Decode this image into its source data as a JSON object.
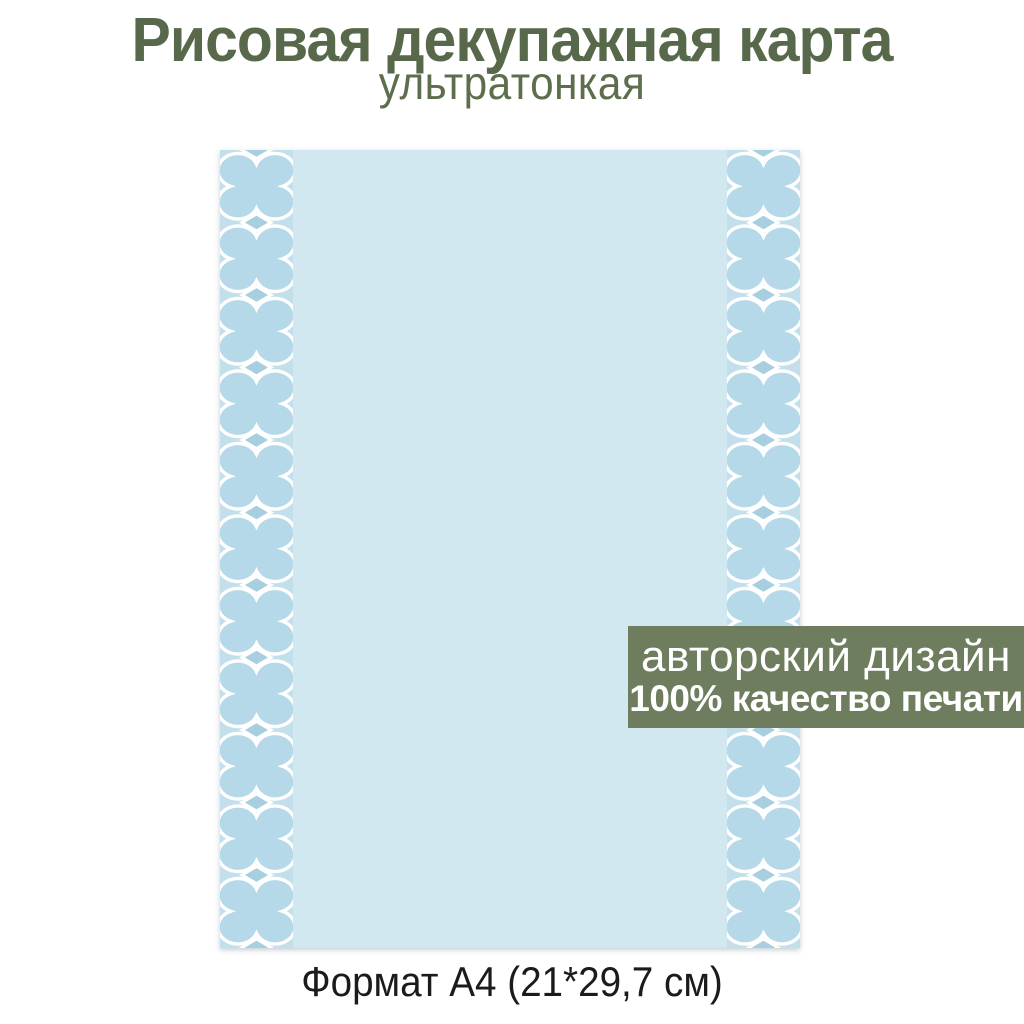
{
  "header": {
    "title": "Рисовая декупажная карта",
    "subtitle": "ультратонкая"
  },
  "badge": {
    "line1": "авторский дизайн",
    "line2": "100% качество печати"
  },
  "footer": {
    "format": "Формат А4 (21*29,7 см)"
  },
  "colors": {
    "title_green": "#57694a",
    "subtitle_green": "#5c6e4c",
    "badge_green": "#6e7d5e",
    "badge_text_white": "#ffffff",
    "paper_blue": "#d2e8f0",
    "band_blue": "#a7cfdf",
    "blob_blue": "#c2dfeb",
    "quatrefoil_inner_blue": "#b5d9e8",
    "pattern_outline_white": "#ffffff",
    "caption_dark": "#1b1b1b",
    "background_white": "#ffffff"
  }
}
